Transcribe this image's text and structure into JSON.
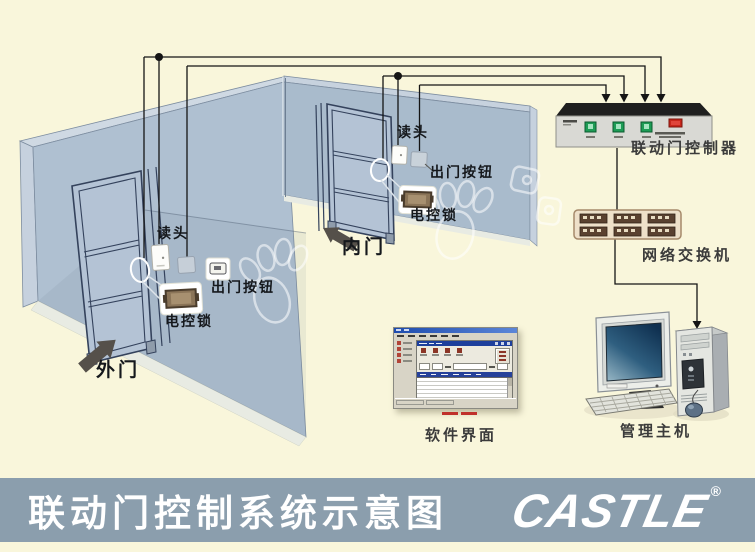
{
  "footer": {
    "title": "联动门控制系统示意图",
    "brand": "CASTLE",
    "registered_mark": "®",
    "bar_color": "#8b9ead"
  },
  "diagram": {
    "door_labels": {
      "outer_door": "外门",
      "inner_door": "内门"
    },
    "outer_door_devices": {
      "reader": "读头",
      "exit_button": "出门按钮",
      "electric_lock": "电控锁"
    },
    "inner_door_devices": {
      "reader": "读头",
      "exit_button": "出门按钮",
      "electric_lock": "电控锁"
    },
    "equipment_labels": {
      "controller": "联动门控制器",
      "network_switch": "网络交换机",
      "management_host": "管理主机",
      "software_ui": "软件界面"
    },
    "colors": {
      "background": "#f9f6db",
      "wall": "#afc0d1",
      "wall_dark": "#a9bbcc",
      "wire": "#151515",
      "controller_led_green": "#1d9c55",
      "controller_button_red": "#c8271b",
      "switch_body": "#eee0c9",
      "switch_port": "#5a4130"
    }
  }
}
